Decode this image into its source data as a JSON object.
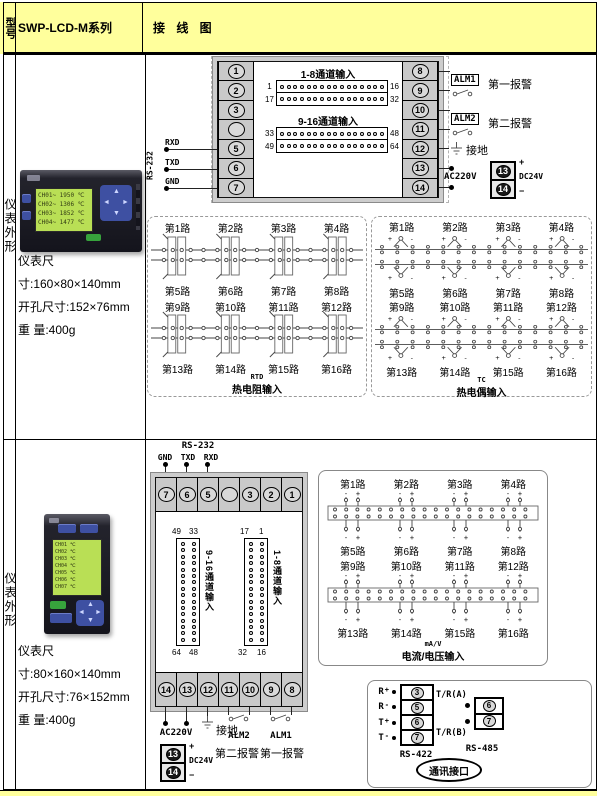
{
  "header": {
    "model": "型号",
    "series": "SWP-LCD-M系列",
    "wiring": "接 线 图"
  },
  "symbols": {
    "plus": "+",
    "minus": "-"
  },
  "row1": {
    "side_label": "仪表外形",
    "instrument": {
      "lcd_lines": [
        "CH01~ 1950 ℃",
        "CH02~ 1306 ℃",
        "CH03~ 1852 ℃",
        "CH04~ 1477 ℃"
      ]
    },
    "specs": [
      "仪表尺",
      "寸:160×80×140mm",
      "开孔尺寸:152×76mm",
      "重 量:400g"
    ],
    "rear": {
      "left_terminals": [
        "1",
        "2",
        "3",
        "",
        "5",
        "6",
        "7"
      ],
      "right_terminals": [
        "8",
        "9",
        "10",
        "11",
        "12",
        "13",
        "14"
      ],
      "rs232": "RS-232",
      "pins": [
        "RXD",
        "TXD",
        "GND"
      ],
      "group1_title": "1-8通道输入",
      "strip1": {
        "r1l": "1",
        "r1r": "16",
        "r2l": "17",
        "r2r": "32"
      },
      "group2_title": "9-16通道输入",
      "strip2": {
        "r1l": "33",
        "r1r": "48",
        "r2l": "49",
        "r2r": "64"
      },
      "alm1": "ALM1",
      "alm1_text": "第一报警",
      "alm2": "ALM2",
      "alm2_text": "第二报警",
      "ground": "接地",
      "ac": "AC220V",
      "dc": "DC24V",
      "dc_terminals": [
        "13",
        "14"
      ]
    },
    "rtd_box": {
      "groups": [
        {
          "top": [
            "第1路",
            "第2路",
            "第3路",
            "第4路"
          ],
          "bottom": [
            "第5路",
            "第6路",
            "第7路",
            "第8路"
          ]
        },
        {
          "top": [
            "第9路",
            "第10路",
            "第11路",
            "第12路"
          ],
          "bottom": [
            "第13路",
            "第14路",
            "第15路",
            "第16路"
          ]
        }
      ],
      "cap1": "RTD",
      "cap2": "热电阻输入"
    },
    "tc_box": {
      "groups": [
        {
          "top": [
            "第1路",
            "第2路",
            "第3路",
            "第4路"
          ],
          "bottom": [
            "第5路",
            "第6路",
            "第7路",
            "第8路"
          ]
        },
        {
          "top": [
            "第9路",
            "第10路",
            "第11路",
            "第12路"
          ],
          "bottom": [
            "第13路",
            "第14路",
            "第15路",
            "第16路"
          ]
        }
      ],
      "cap1": "TC",
      "cap2": "热电偶输入"
    }
  },
  "row2": {
    "side_label": "仪表外形",
    "instrument": {
      "lcd_lines": [
        "CH01 ℃",
        "CH02 ℃",
        "CH03 ℃",
        "CH04 ℃",
        "CH05 ℃",
        "CH06 ℃",
        "CH07 ℃"
      ]
    },
    "specs": [
      "仪表尺",
      "寸:80×160×140mm",
      "开孔尺寸:76×152mm",
      "重 量:400g"
    ],
    "rear": {
      "rs232": "RS-232",
      "pins": [
        "GND",
        "TXD",
        "RXD"
      ],
      "top_terminals": [
        "7",
        "6",
        "5",
        "",
        "3",
        "2",
        "1"
      ],
      "bottom_terminals": [
        "14",
        "13",
        "12",
        "11",
        "10",
        "9",
        "8"
      ],
      "left_strip": {
        "title": "9-16通道输入",
        "tl": "49",
        "tr": "33",
        "bl": "64",
        "br": "48"
      },
      "right_strip": {
        "title": "1-8通道输入",
        "tl": "17",
        "tr": "1",
        "bl": "32",
        "br": "16"
      },
      "ac": "AC220V",
      "ground": "接地",
      "alm2": "ALM2",
      "alm2_text": "第二报警",
      "alm1": "ALM1",
      "alm1_text": "第一报警",
      "dc": "DC24V",
      "dc_terminals": [
        "13",
        "14"
      ]
    },
    "mav_box": {
      "groups": [
        {
          "top": [
            "第1路",
            "第2路",
            "第3路",
            "第4路"
          ],
          "bottom": [
            "第5路",
            "第6路",
            "第7路",
            "第8路"
          ]
        },
        {
          "top": [
            "第9路",
            "第10路",
            "第11路",
            "第12路"
          ],
          "bottom": [
            "第13路",
            "第14路",
            "第15路",
            "第16路"
          ]
        }
      ],
      "cap1": "mA/V",
      "cap2": "电流/电压输入"
    },
    "comm_box": {
      "rs422_label": "RS-422",
      "rs422_pins": [
        {
          "name": "R",
          "sign": "+"
        },
        {
          "name": "R",
          "sign": "-"
        },
        {
          "name": "T",
          "sign": "+"
        },
        {
          "name": "T",
          "sign": "-"
        }
      ],
      "rs422_terminals": [
        "3",
        "5",
        "6",
        "7"
      ],
      "rs485_label": "RS-485",
      "rs485_a": "T/R(A)",
      "rs485_b": "T/R(B)",
      "rs485_terminals": [
        "6",
        "7"
      ],
      "oval": "通讯接口"
    }
  }
}
